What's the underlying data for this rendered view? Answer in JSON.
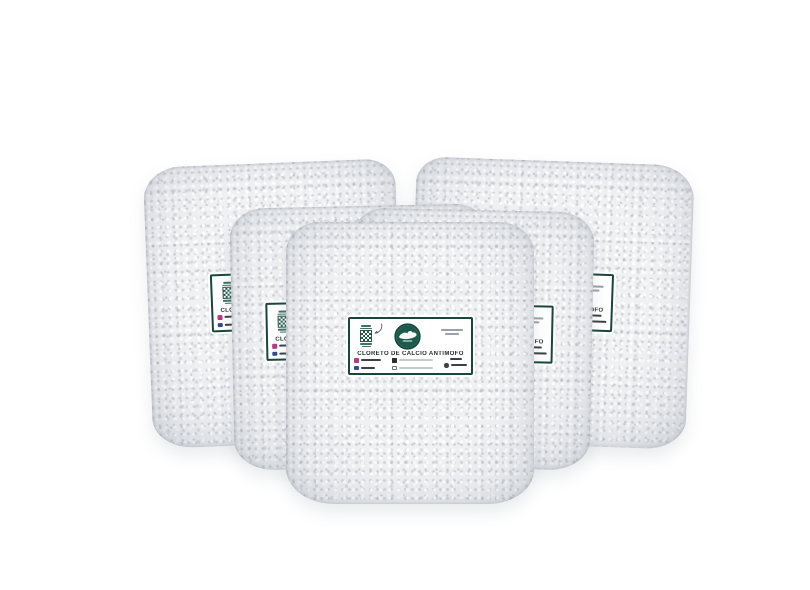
{
  "scene": {
    "background_color": "#ffffff",
    "bag_count": 5,
    "product": "Bags of white granules (anti-mold calcium chloride)"
  },
  "label": {
    "title": "CLORETO DE CÁLCIO ANTIMOFO",
    "icons": [
      "qr-code-icon",
      "curved-arrow-icon",
      "brand-logo-icon",
      "instagram-icon",
      "facebook-icon",
      "email-icon",
      "website-icon",
      "whatsapp-icon"
    ],
    "colors": {
      "label_border_green": "#17463a",
      "logo_circle_green": "#1d5a4b",
      "qr_green": "#23564a",
      "title_text": "#232e29",
      "instagram_pink": "#d6366c",
      "facebook_blue": "#2f4d8f",
      "contact_dark": "#3a4046"
    }
  }
}
